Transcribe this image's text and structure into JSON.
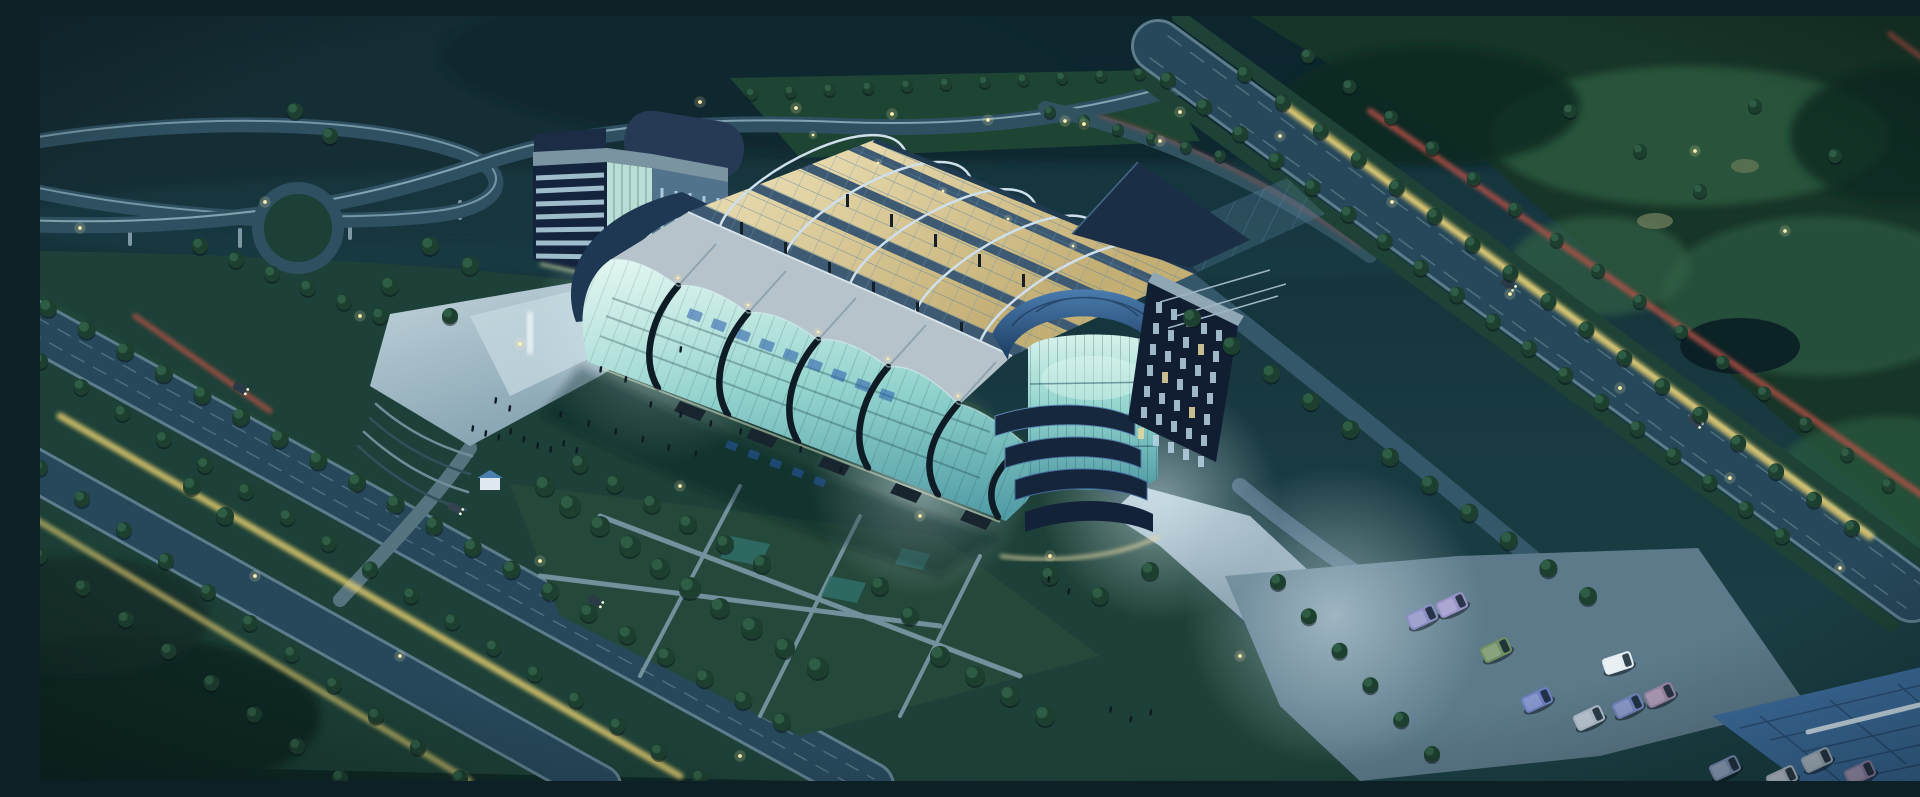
{
  "meta": {
    "description": "Aerial dusk architectural rendering of a glass exhibition-center complex with open steel truss roof, office buildings, highway interchange, tree-lined boulevards with light trails, plazas and a bus parking lot"
  },
  "colors": {
    "sky_top": "#0f2730",
    "hill": "#16343c",
    "forest": "#15342a",
    "fairway": "#2d5c41",
    "terrain": "#1d4138",
    "road": "#2b4d5c",
    "road_edge": "#7fa2b2",
    "grass_strip": "#1f4436",
    "plaza": "#9db6c2",
    "plaza_lit": "#c6d8e0",
    "glass_hi": "#d6f2ea",
    "glass_lo": "#4f9aa4",
    "rib_dark": "#0e1c26",
    "roof_pale": "#b6c3ca",
    "truss_warm": "#e2d4a2",
    "truss_grid": "#55809e",
    "arch_steel": "#cfe0ec",
    "navy": "#14243c",
    "dome_hi": "#4a7cae",
    "dome_lo": "#1b3a5e",
    "peak": "#1a2f45",
    "canopy_blue": "#3c6d9c",
    "trail_yellow": "#e2cb6e",
    "trail_red": "#bf5147",
    "lamp": "#ffeeb0",
    "tree_dark": "#1d3f30",
    "tree_lite": "#2f5c44",
    "people": "#0e1a22",
    "signage_blue": "rgba(40,90,170,0.55)",
    "window_slit": "#b7d2e4",
    "window_lit": "#e6d8a0"
  },
  "scene": {
    "tree_rows": [
      {
        "x1": 8,
        "y1": 292,
        "x2": 742,
        "y2": 706,
        "n": 20,
        "r": 9
      },
      {
        "x1": 0,
        "y1": 345,
        "x2": 660,
        "y2": 762,
        "n": 17,
        "r": 8
      },
      {
        "x1": 0,
        "y1": 452,
        "x2": 420,
        "y2": 762,
        "n": 11,
        "r": 8
      },
      {
        "x1": 0,
        "y1": 540,
        "x2": 300,
        "y2": 762,
        "n": 8,
        "r": 8
      },
      {
        "x1": 1128,
        "y1": 64,
        "x2": 1742,
        "y2": 520,
        "n": 18,
        "r": 8
      },
      {
        "x1": 1205,
        "y1": 58,
        "x2": 1812,
        "y2": 512,
        "n": 17,
        "r": 8
      },
      {
        "x1": 1268,
        "y1": 40,
        "x2": 1890,
        "y2": 500,
        "n": 16,
        "r": 7
      },
      {
        "x1": 1152,
        "y1": 302,
        "x2": 1548,
        "y2": 580,
        "n": 11,
        "r": 9
      },
      {
        "x1": 712,
        "y1": 78,
        "x2": 1100,
        "y2": 58,
        "n": 11,
        "r": 6
      },
      {
        "x1": 1238,
        "y1": 566,
        "x2": 1392,
        "y2": 738,
        "n": 6,
        "r": 8
      },
      {
        "x1": 1010,
        "y1": 96,
        "x2": 1180,
        "y2": 140,
        "n": 6,
        "r": 6
      },
      {
        "x1": 160,
        "y1": 230,
        "x2": 340,
        "y2": 300,
        "n": 6,
        "r": 8
      }
    ],
    "trees": [
      [
        505,
        470,
        10
      ],
      [
        530,
        490,
        11
      ],
      [
        560,
        510,
        10
      ],
      [
        590,
        530,
        11
      ],
      [
        620,
        552,
        10
      ],
      [
        650,
        572,
        11
      ],
      [
        680,
        592,
        10
      ],
      [
        712,
        612,
        11
      ],
      [
        745,
        632,
        10
      ],
      [
        778,
        652,
        11
      ],
      [
        540,
        448,
        9
      ],
      [
        575,
        468,
        9
      ],
      [
        612,
        488,
        9
      ],
      [
        648,
        508,
        9
      ],
      [
        685,
        528,
        9
      ],
      [
        722,
        548,
        9
      ],
      [
        900,
        640,
        10
      ],
      [
        935,
        660,
        10
      ],
      [
        970,
        680,
        10
      ],
      [
        1005,
        700,
        10
      ],
      [
        870,
        600,
        9
      ],
      [
        840,
        570,
        9
      ],
      [
        1010,
        560,
        9
      ],
      [
        1060,
        580,
        9
      ],
      [
        1110,
        555,
        9
      ],
      [
        430,
        250,
        9
      ],
      [
        390,
        230,
        9
      ],
      [
        350,
        270,
        9
      ],
      [
        410,
        300,
        8
      ],
      [
        1530,
        95,
        7
      ],
      [
        1600,
        135,
        7
      ],
      [
        1660,
        175,
        7
      ],
      [
        1715,
        90,
        7
      ],
      [
        1795,
        140,
        7
      ],
      [
        255,
        95,
        8
      ],
      [
        290,
        120,
        8
      ],
      [
        152,
        470,
        9
      ],
      [
        185,
        500,
        9
      ]
    ],
    "people": [
      [
        432,
        409
      ],
      [
        445,
        414
      ],
      [
        458,
        418
      ],
      [
        470,
        412
      ],
      [
        483,
        420
      ],
      [
        497,
        426
      ],
      [
        510,
        430
      ],
      [
        523,
        424
      ],
      [
        536,
        431
      ],
      [
        469,
        389
      ],
      [
        455,
        381
      ],
      [
        520,
        395
      ],
      [
        548,
        404
      ],
      [
        575,
        412
      ],
      [
        602,
        420
      ],
      [
        628,
        428
      ],
      [
        655,
        434
      ],
      [
        610,
        385
      ],
      [
        640,
        395
      ],
      [
        670,
        404
      ],
      [
        700,
        412
      ],
      [
        560,
        350
      ],
      [
        585,
        360
      ],
      [
        640,
        330
      ],
      [
        760,
        430
      ],
      [
        800,
        450
      ],
      [
        1070,
        690
      ],
      [
        1090,
        700
      ],
      [
        1110,
        693
      ],
      [
        1008,
        560
      ],
      [
        1028,
        572
      ]
    ],
    "lights": [
      [
        40,
        212
      ],
      [
        225,
        186
      ],
      [
        320,
        300
      ],
      [
        480,
        328
      ],
      [
        660,
        86
      ],
      [
        756,
        92
      ],
      [
        852,
        98
      ],
      [
        948,
        104
      ],
      [
        1044,
        108
      ],
      [
        1140,
        96
      ],
      [
        1240,
        120
      ],
      [
        1352,
        186
      ],
      [
        1470,
        278
      ],
      [
        1580,
        372
      ],
      [
        1690,
        462
      ],
      [
        1800,
        552
      ],
      [
        500,
        545
      ],
      [
        360,
        640
      ],
      [
        215,
        560
      ],
      [
        640,
        470
      ],
      [
        880,
        500
      ],
      [
        1010,
        540
      ],
      [
        1200,
        640
      ],
      [
        700,
        740
      ],
      [
        1655,
        135
      ],
      [
        1745,
        215
      ],
      [
        1025,
        105
      ],
      [
        1120,
        125
      ]
    ],
    "ridge_lights": [
      [
        638,
        262
      ],
      [
        708,
        289
      ],
      [
        778,
        316
      ],
      [
        848,
        343
      ],
      [
        918,
        380
      ],
      [
        773,
        119
      ],
      [
        838,
        147
      ],
      [
        903,
        175
      ],
      [
        968,
        203
      ],
      [
        1033,
        230
      ]
    ],
    "posts": [
      [
        700,
        206
      ],
      [
        744,
        226
      ],
      [
        788,
        246
      ],
      [
        832,
        266
      ],
      [
        876,
        286
      ],
      [
        920,
        306
      ],
      [
        806,
        178
      ],
      [
        850,
        198
      ],
      [
        894,
        218
      ],
      [
        938,
        238
      ],
      [
        982,
        258
      ],
      [
        1026,
        278
      ]
    ],
    "glyphs": [
      [
        650,
        292,
        14,
        10
      ],
      [
        674,
        302,
        14,
        10
      ],
      [
        698,
        312,
        14,
        10
      ],
      [
        722,
        322,
        14,
        10
      ],
      [
        746,
        332,
        14,
        10
      ],
      [
        770,
        342,
        14,
        10
      ],
      [
        794,
        352,
        14,
        10
      ],
      [
        818,
        362,
        14,
        10
      ],
      [
        842,
        372,
        14,
        10
      ],
      [
        688,
        424,
        11,
        8
      ],
      [
        710,
        433,
        11,
        8
      ],
      [
        732,
        442,
        11,
        8
      ],
      [
        754,
        451,
        11,
        8
      ],
      [
        776,
        460,
        11,
        8
      ]
    ],
    "vans": [
      [
        1382,
        601,
        -25,
        "#8b8fc4"
      ],
      [
        1412,
        589,
        -25,
        "#9a93c9"
      ],
      [
        1456,
        634,
        -25,
        "#6f8f63"
      ],
      [
        1578,
        647,
        -18,
        "#e4edf2"
      ],
      [
        1497,
        684,
        -25,
        "#6d7fc0"
      ],
      [
        1549,
        702,
        -25,
        "#aebccb"
      ],
      [
        1588,
        690,
        -25,
        "#7284bd"
      ],
      [
        1620,
        679,
        -25,
        "#9b87a6"
      ],
      [
        1777,
        744,
        -25,
        "#9fb0bd"
      ],
      [
        1820,
        757,
        -25,
        "#8f84a8"
      ],
      [
        1742,
        762,
        -25,
        "#b0bcc8"
      ],
      [
        1685,
        752,
        -25,
        "#7b8fb0"
      ]
    ],
    "cars": [
      [
        200,
        372,
        29,
        "#2a3a46"
      ],
      [
        415,
        492,
        29,
        "#33424e"
      ],
      [
        555,
        585,
        29,
        "#2a3a46"
      ],
      [
        1468,
        268,
        36,
        "#2a3a46"
      ],
      [
        1655,
        405,
        36,
        "#33424e"
      ]
    ],
    "office_grid": {
      "x0": 1116,
      "y0": 286,
      "cdx": 15,
      "cdy": 7,
      "rdx": -3,
      "rdy": 21,
      "cols": 5,
      "rows": 7,
      "lit": [
        8,
        16,
        23,
        30
      ]
    }
  }
}
